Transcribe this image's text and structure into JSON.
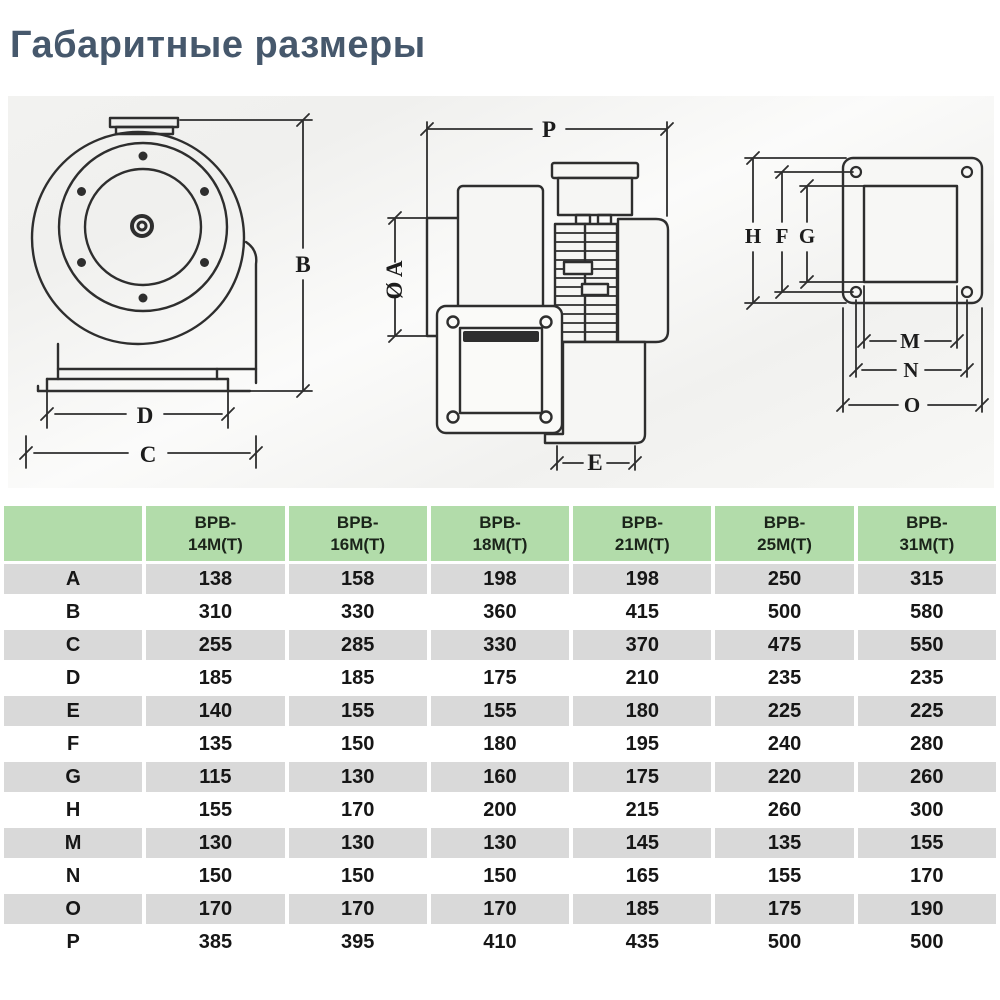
{
  "page": {
    "title": "Габаритные размеры"
  },
  "colors": {
    "title": "#46586c",
    "table_header_bg": "#b2dcaa",
    "table_alt_row_bg": "#d9d9d9",
    "drawing_line": "#2e2e2e"
  },
  "drawings": {
    "front_view": {
      "dim_b": "B",
      "dim_c": "C",
      "dim_d": "D"
    },
    "side_view": {
      "dim_p": "P",
      "dim_a": "Ø A",
      "dim_e": "E"
    },
    "flange_view": {
      "dim_h": "H",
      "dim_f": "F",
      "dim_g": "G",
      "dim_m": "M",
      "dim_n": "N",
      "dim_o": "O"
    }
  },
  "table": {
    "columns": [
      {
        "line1": "BPB-",
        "line2": "14M(T)"
      },
      {
        "line1": "BPB-",
        "line2": "16M(T)"
      },
      {
        "line1": "BPB-",
        "line2": "18M(T)"
      },
      {
        "line1": "BPB-",
        "line2": "21M(T)"
      },
      {
        "line1": "BPB-",
        "line2": "25M(T)"
      },
      {
        "line1": "BPB-",
        "line2": "31M(T)"
      }
    ],
    "rows": [
      {
        "label": "A",
        "values": [
          "138",
          "158",
          "198",
          "198",
          "250",
          "315"
        ]
      },
      {
        "label": "B",
        "values": [
          "310",
          "330",
          "360",
          "415",
          "500",
          "580"
        ]
      },
      {
        "label": "C",
        "values": [
          "255",
          "285",
          "330",
          "370",
          "475",
          "550"
        ]
      },
      {
        "label": "D",
        "values": [
          "185",
          "185",
          "175",
          "210",
          "235",
          "235"
        ]
      },
      {
        "label": "E",
        "values": [
          "140",
          "155",
          "155",
          "180",
          "225",
          "225"
        ]
      },
      {
        "label": "F",
        "values": [
          "135",
          "150",
          "180",
          "195",
          "240",
          "280"
        ]
      },
      {
        "label": "G",
        "values": [
          "115",
          "130",
          "160",
          "175",
          "220",
          "260"
        ]
      },
      {
        "label": "H",
        "values": [
          "155",
          "170",
          "200",
          "215",
          "260",
          "300"
        ]
      },
      {
        "label": "M",
        "values": [
          "130",
          "130",
          "130",
          "145",
          "135",
          "155"
        ]
      },
      {
        "label": "N",
        "values": [
          "150",
          "150",
          "150",
          "165",
          "155",
          "170"
        ]
      },
      {
        "label": "O",
        "values": [
          "170",
          "170",
          "170",
          "185",
          "175",
          "190"
        ]
      },
      {
        "label": "P",
        "values": [
          "385",
          "395",
          "410",
          "435",
          "500",
          "500"
        ]
      }
    ]
  }
}
